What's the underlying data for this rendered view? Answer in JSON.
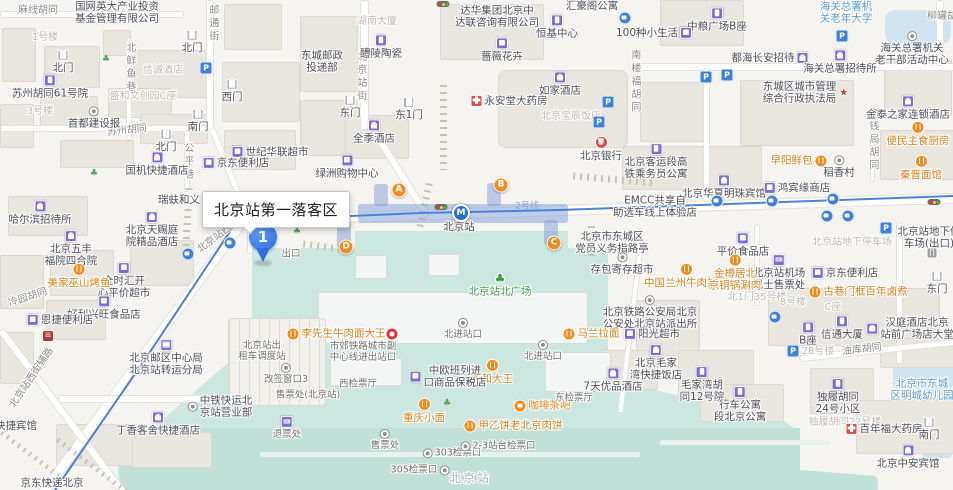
{
  "callout": {
    "text": "北京站第一落客区"
  },
  "marker": {
    "label": "1"
  },
  "metro": {
    "station": "北京站",
    "line": "2号线"
  },
  "colors": {
    "accent_blue": "#2e6ee0",
    "teal": "#cbe7e0",
    "orange": "#f08c1e",
    "poi_purple": "#7d6cd2",
    "metro_line": "#4a82d8",
    "entrance_orange": "#f08c1e"
  },
  "entrances": [
    {
      "label": "A",
      "x": 399,
      "y": 190
    },
    {
      "label": "B",
      "x": 501,
      "y": 185
    },
    {
      "label": "C",
      "x": 554,
      "y": 243
    },
    {
      "label": "D",
      "x": 346,
      "y": 247
    }
  ],
  "labels": [
    {
      "t": "麻线胡同",
      "x": 38,
      "y": 11,
      "k": "road"
    },
    {
      "t": "邮通街",
      "x": 212,
      "y": 24,
      "k": "roadv"
    },
    {
      "t": "北鲜鱼巷",
      "x": 129,
      "y": 68,
      "k": "roadv"
    },
    {
      "t": "苏州胡同",
      "x": 127,
      "y": 131,
      "k": "road",
      "r": -6
    },
    {
      "t": "北京站街",
      "x": 360,
      "y": 77,
      "k": "roadv"
    },
    {
      "t": "公平巷",
      "x": 187,
      "y": 162,
      "k": "roadv"
    },
    {
      "t": "南楼福胡同",
      "x": 634,
      "y": 82,
      "k": "roadv"
    },
    {
      "t": "老钱局胡同",
      "x": 872,
      "y": 140,
      "k": "roadv"
    },
    {
      "t": "柳罐胡同",
      "x": 947,
      "y": 17,
      "k": "road"
    },
    {
      "t": "北京站西街",
      "x": 219,
      "y": 236,
      "k": "road",
      "r": -37
    },
    {
      "t": "北京站西街辅路",
      "x": 32,
      "y": 378,
      "k": "road",
      "r": -56
    },
    {
      "t": "冷园胡同",
      "x": 28,
      "y": 298,
      "k": "road",
      "r": -18
    },
    {
      "t": "油库胡同",
      "x": 862,
      "y": 350,
      "k": "road",
      "r": -7
    },
    {
      "t": "2号线",
      "x": 527,
      "y": 207,
      "k": "line"
    },
    {
      "t": "1号楼",
      "x": 45,
      "y": 38,
      "k": "faint"
    },
    {
      "t": "3号楼",
      "x": 40,
      "y": 112,
      "k": "faint"
    },
    {
      "t": "信诚酒店",
      "x": 163,
      "y": 71,
      "k": "faint"
    },
    {
      "t": "盛和文创园C座",
      "x": 143,
      "y": 97,
      "k": "faint"
    },
    {
      "t": "湖南大厦",
      "x": 377,
      "y": 22,
      "k": "faint"
    },
    {
      "t": "北京宝辰饭店",
      "x": 571,
      "y": 117,
      "k": "faint"
    },
    {
      "t": "北京站地下停车场",
      "x": 852,
      "y": 243,
      "k": "faint"
    },
    {
      "t": "北1门35号楼",
      "x": 757,
      "y": 298,
      "k": "faint"
    },
    {
      "t": "8号楼",
      "x": 793,
      "y": 303,
      "k": "faint"
    },
    {
      "t": "C座",
      "x": 833,
      "y": 308,
      "k": "faint"
    },
    {
      "t": "28号楼",
      "x": 818,
      "y": 352,
      "k": "faint"
    },
    {
      "t": "独履胡同22号楼",
      "x": 845,
      "y": 423,
      "k": "faint"
    },
    {
      "t": "北京站",
      "x": 470,
      "y": 478,
      "k": "bigfaint"
    },
    {
      "t": "国网英大产业投资|基金管理有限公司",
      "x": 117,
      "y": 13,
      "k": "poi"
    },
    {
      "t": "苏州胡同61号院",
      "x": 50,
      "y": 87,
      "k": "poi",
      "i": "bldg",
      "ip": "t"
    },
    {
      "t": "首都建设报",
      "x": 94,
      "y": 118,
      "k": "poi",
      "i": "circ",
      "ip": "t"
    },
    {
      "t": "国机快捷酒店",
      "x": 157,
      "y": 164,
      "k": "poi",
      "i": "hotel",
      "ip": "t"
    },
    {
      "t": "世纪华联超市",
      "x": 270,
      "y": 152,
      "k": "poi",
      "i": "shop",
      "ip": "l"
    },
    {
      "t": "京东便利店",
      "x": 236,
      "y": 163,
      "k": "poi",
      "i": "shop",
      "ip": "l"
    },
    {
      "t": "东城邮政|投递部",
      "x": 322,
      "y": 62,
      "k": "poi"
    },
    {
      "t": "醴陵陶瓷",
      "x": 381,
      "y": 47,
      "k": "poi",
      "i": "bldg",
      "ip": "t"
    },
    {
      "t": "全季酒店",
      "x": 374,
      "y": 132,
      "k": "poi",
      "i": "hotel",
      "ip": "t"
    },
    {
      "t": "绿洲购物中心",
      "x": 347,
      "y": 167,
      "k": "poi",
      "i": "shop",
      "ip": "t"
    },
    {
      "t": "北门",
      "x": 63,
      "y": 62,
      "k": "poi",
      "i": "gate",
      "ip": "t"
    },
    {
      "t": "北门",
      "x": 192,
      "y": 42,
      "k": "poi",
      "i": "gate",
      "ip": "t"
    },
    {
      "t": "南门",
      "x": 198,
      "y": 121,
      "k": "poi",
      "i": "gate",
      "ip": "t"
    },
    {
      "t": "西门",
      "x": 232,
      "y": 91,
      "k": "poi",
      "i": "gate",
      "ip": "t"
    },
    {
      "t": "北门",
      "x": 166,
      "y": 141,
      "k": "poi",
      "i": "gate",
      "ip": "t"
    },
    {
      "t": "东门",
      "x": 350,
      "y": 107,
      "k": "poi",
      "i": "gate",
      "ip": "t"
    },
    {
      "t": "东1门",
      "x": 409,
      "y": 109,
      "k": "poi",
      "i": "gate",
      "ip": "t"
    },
    {
      "t": "达华集团北京中|达联咨询有限公司",
      "x": 497,
      "y": 17,
      "k": "poi"
    },
    {
      "t": "蔷薇花卉",
      "x": 502,
      "y": 50,
      "k": "poi",
      "i": "shop",
      "ip": "t"
    },
    {
      "t": "恒基中心",
      "x": 557,
      "y": 27,
      "k": "poi",
      "i": "bldg",
      "ip": "t"
    },
    {
      "t": "汇豪阁公寓",
      "x": 592,
      "y": 6,
      "k": "poi"
    },
    {
      "t": "如家酒店",
      "x": 560,
      "y": 84,
      "k": "poi",
      "i": "hotel",
      "ip": "t"
    },
    {
      "t": "永安堂大药房",
      "x": 509,
      "y": 101,
      "k": "poi",
      "i": "pharm",
      "ip": "l"
    },
    {
      "t": "北京银行",
      "x": 601,
      "y": 149,
      "k": "poi",
      "i": "bank",
      "ip": "t"
    },
    {
      "t": "中粮广场B座",
      "x": 717,
      "y": 20,
      "k": "poi",
      "i": "bldg",
      "ip": "t"
    },
    {
      "t": "100种小生活",
      "x": 654,
      "y": 33,
      "k": "poi",
      "i": "shop",
      "ip": "r"
    },
    {
      "t": "海关总署机|关老年大学",
      "x": 846,
      "y": 13,
      "k": "blue"
    },
    {
      "t": "海关总署机关|老干部活动中心",
      "x": 912,
      "y": 49,
      "k": "poi",
      "i": "circ",
      "ip": "t"
    },
    {
      "t": "都海长安招待",
      "x": 770,
      "y": 58,
      "k": "poi",
      "i": "hotel",
      "ip": "r"
    },
    {
      "t": "海关总署招待所",
      "x": 840,
      "y": 62,
      "k": "poi",
      "i": "hotel",
      "ip": "t"
    },
    {
      "t": "东城区城市管理|综合行政执法局",
      "x": 806,
      "y": 93,
      "k": "poi",
      "i": "star",
      "ip": "r"
    },
    {
      "t": "金泰之家连锁酒店",
      "x": 908,
      "y": 108,
      "k": "poi",
      "i": "hotel",
      "ip": "t"
    },
    {
      "t": "北京客运段高|铁乘务员公寓",
      "x": 656,
      "y": 162,
      "k": "poi",
      "i": "bldg",
      "ip": "t"
    },
    {
      "t": "北京华夏明珠宾馆",
      "x": 724,
      "y": 187,
      "k": "poi",
      "i": "hotel",
      "ip": "t"
    },
    {
      "t": "鸿宾缘商店",
      "x": 797,
      "y": 188,
      "k": "poi",
      "i": "shop",
      "ip": "l"
    },
    {
      "t": "EMCC共享自|助选车线上体验店",
      "x": 655,
      "y": 207,
      "k": "poi"
    },
    {
      "t": "北京市东城区|党员义务指路亭",
      "x": 612,
      "y": 243,
      "k": "poi"
    },
    {
      "t": "存包寄存超市",
      "x": 622,
      "y": 264,
      "k": "poi",
      "i": "circ",
      "ip": "t"
    },
    {
      "t": "平价食品店",
      "x": 743,
      "y": 245,
      "k": "poi",
      "i": "shop",
      "ip": "t"
    },
    {
      "t": "北京站机场|巴士售票处",
      "x": 779,
      "y": 273,
      "k": "poi",
      "i": "ticket",
      "ip": "t"
    },
    {
      "t": "京东便利店",
      "x": 845,
      "y": 273,
      "k": "poi",
      "i": "shop",
      "ip": "l"
    },
    {
      "t": "北京站地下停|车场(出口)",
      "x": 929,
      "y": 238,
      "k": "poi"
    },
    {
      "t": "东门",
      "x": 937,
      "y": 283,
      "k": "poi",
      "i": "gate",
      "ip": "t"
    },
    {
      "t": "信通大厦",
      "x": 842,
      "y": 328,
      "k": "poi",
      "i": "bldg",
      "ip": "t"
    },
    {
      "t": "B座",
      "x": 808,
      "y": 334,
      "k": "poi",
      "i": "bldg",
      "ip": "t"
    },
    {
      "t": "汉庭酒店北京|站前广场店大堂",
      "x": 910,
      "y": 329,
      "k": "poi",
      "i": "hotel",
      "ip": "l"
    },
    {
      "t": "北京铁路公安局北京|公安处北京站派出所",
      "x": 650,
      "y": 313,
      "k": "poi",
      "i": "circ",
      "ip": "t"
    },
    {
      "t": "阳光超市",
      "x": 652,
      "y": 334,
      "k": "poi",
      "i": "shop",
      "ip": "l"
    },
    {
      "t": "北京毛家|湾快捷饭店",
      "x": 656,
      "y": 363,
      "k": "poi",
      "i": "hotel",
      "ip": "t"
    },
    {
      "t": "7天优品酒店",
      "x": 613,
      "y": 380,
      "k": "poi",
      "i": "hotel",
      "ip": "t"
    },
    {
      "t": "毛家湾胡|同12号院",
      "x": 702,
      "y": 385,
      "k": "poi",
      "i": "bldg",
      "ip": "t"
    },
    {
      "t": "行车公寓|段北京公寓",
      "x": 740,
      "y": 405,
      "k": "poi",
      "i": "bldg",
      "ip": "t"
    },
    {
      "t": "独履胡同|24号小区",
      "x": 838,
      "y": 397,
      "k": "poi",
      "i": "bldg",
      "ip": "t"
    },
    {
      "t": "百年福大药房",
      "x": 884,
      "y": 429,
      "k": "poi",
      "i": "pharm",
      "ip": "l"
    },
    {
      "t": "南门",
      "x": 929,
      "y": 429,
      "k": "poi",
      "i": "gate",
      "ip": "t"
    },
    {
      "t": "北京中安宾馆",
      "x": 908,
      "y": 457,
      "k": "poi",
      "i": "hotel",
      "ip": "t"
    },
    {
      "t": "北京市东城|区明城幼儿园",
      "x": 922,
      "y": 390,
      "k": "blue"
    },
    {
      "t": "哈尔滨招待所",
      "x": 40,
      "y": 213,
      "k": "poi",
      "i": "hotel",
      "ip": "t"
    },
    {
      "t": "北京五丰|福院四合院",
      "x": 71,
      "y": 249,
      "k": "poi",
      "i": "hotel",
      "ip": "t"
    },
    {
      "t": "全时汇开|心平价超市",
      "x": 124,
      "y": 281,
      "k": "poi",
      "i": "shop",
      "ip": "t"
    },
    {
      "t": "好利兴旺食品店",
      "x": 104,
      "y": 308,
      "k": "poi",
      "i": "shop",
      "ip": "t"
    },
    {
      "t": "恩捷便利店",
      "x": 60,
      "y": 320,
      "k": "poi",
      "i": "shop",
      "ip": "l"
    },
    {
      "t": "北京天赐庭|院精品酒店",
      "x": 152,
      "y": 230,
      "k": "poi",
      "i": "hotel",
      "ip": "t"
    },
    {
      "t": "瑞蚨和义",
      "x": 179,
      "y": 200,
      "k": "poi"
    },
    {
      "t": "北京邮区中心局|北京站转运分局",
      "x": 166,
      "y": 358,
      "k": "poi",
      "i": "mail",
      "ip": "t"
    },
    {
      "t": "丁香客舍快捷酒店",
      "x": 158,
      "y": 424,
      "k": "poi",
      "i": "hotel",
      "ip": "t"
    },
    {
      "t": "中铁快运北|京站营业部",
      "x": 220,
      "y": 407,
      "k": "poi",
      "i": "circ",
      "ip": "l"
    },
    {
      "t": "京东快递北京",
      "x": 52,
      "y": 483,
      "k": "poi"
    },
    {
      "t": "快捷宾馆",
      "x": 16,
      "y": 426,
      "k": "poi"
    },
    {
      "t": "便民主食厨房",
      "x": 918,
      "y": 134,
      "k": "food",
      "i": "ut",
      "ip": "t"
    },
    {
      "t": "早阳鲜包",
      "x": 799,
      "y": 161,
      "k": "food",
      "i": "ut",
      "ip": "r"
    },
    {
      "t": "稻香村",
      "x": 839,
      "y": 167,
      "k": "poi",
      "i": "circ",
      "ip": "t"
    },
    {
      "t": "秦晋面馆",
      "x": 921,
      "y": 168,
      "k": "food",
      "i": "ut",
      "ip": "t"
    },
    {
      "t": "中国兰州牛肉拉面",
      "x": 686,
      "y": 276,
      "k": "food",
      "i": "ut",
      "ip": "t"
    },
    {
      "t": "金樽居北|京铜锅涮肉",
      "x": 735,
      "y": 273,
      "k": "food",
      "i": "ut",
      "ip": "t"
    },
    {
      "t": "古巷门框百年卤煮",
      "x": 858,
      "y": 292,
      "k": "food",
      "i": "ut",
      "ip": "l"
    },
    {
      "t": "马兰拉面",
      "x": 591,
      "y": 334,
      "k": "food",
      "i": "ut",
      "ip": "l"
    },
    {
      "t": "李先生牛肉面大王",
      "x": 336,
      "y": 334,
      "k": "food",
      "i": "ut",
      "ip": "l"
    },
    {
      "t": "永和大王",
      "x": 492,
      "y": 372,
      "k": "food",
      "i": "ut",
      "ip": "t"
    },
    {
      "t": "咖啡茶吧",
      "x": 542,
      "y": 406,
      "k": "food",
      "i": "coffee",
      "ip": "l"
    },
    {
      "t": "重庆小面",
      "x": 424,
      "y": 411,
      "k": "food",
      "i": "ut",
      "ip": "t"
    },
    {
      "t": "甲乙饼老北京肉饼",
      "x": 513,
      "y": 426,
      "k": "food",
      "i": "ut",
      "ip": "l"
    },
    {
      "t": "美家巫山烤鱼",
      "x": 79,
      "y": 276,
      "k": "food",
      "i": "ut",
      "ip": "t"
    },
    {
      "t": "北京站北广场",
      "x": 500,
      "y": 285,
      "k": "green",
      "i": "tree",
      "ip": "t"
    },
    {
      "t": "出口",
      "x": 291,
      "y": 254,
      "k": "station"
    },
    {
      "t": "北进站口",
      "x": 463,
      "y": 329,
      "k": "station",
      "i": "circ",
      "ip": "t"
    },
    {
      "t": "北进站口",
      "x": 543,
      "y": 351,
      "k": "station",
      "i": "circ",
      "ip": "t"
    },
    {
      "t": "北京站出|租车调度站",
      "x": 262,
      "y": 351,
      "k": "station"
    },
    {
      "t": "市郊铁路城市副|中心线进出站口",
      "x": 363,
      "y": 352,
      "k": "station"
    },
    {
      "t": "改签窗口3",
      "x": 286,
      "y": 374,
      "k": "station",
      "i": "circ",
      "ip": "t"
    },
    {
      "t": "西检票厅",
      "x": 358,
      "y": 384,
      "k": "station"
    },
    {
      "t": "售票处(北京站)",
      "x": 308,
      "y": 395,
      "k": "station"
    },
    {
      "t": "中欧班列进|口商品保税店",
      "x": 448,
      "y": 377,
      "k": "poi",
      "i": "shop",
      "ip": "l"
    },
    {
      "t": "退票处",
      "x": 287,
      "y": 428,
      "k": "station",
      "i": "ticket",
      "ip": "t"
    },
    {
      "t": "售票处",
      "x": 385,
      "y": 440,
      "k": "station",
      "i": "circ",
      "ip": "t"
    },
    {
      "t": "303检票口",
      "x": 452,
      "y": 453,
      "k": "station",
      "i": "circ",
      "ip": "l"
    },
    {
      "t": "2-3站台检票口",
      "x": 498,
      "y": 446,
      "k": "station",
      "i": "circ",
      "ip": "l"
    },
    {
      "t": "305检票口",
      "x": 420,
      "y": 470,
      "k": "station",
      "i": "circ",
      "ip": "r"
    },
    {
      "t": "东检票厅",
      "x": 574,
      "y": 398,
      "k": "station"
    },
    {
      "t": "北京站",
      "x": 459,
      "y": 227,
      "k": "stationbold"
    }
  ],
  "icons": [
    {
      "k": "parking",
      "x": 206,
      "y": 68
    },
    {
      "k": "parking",
      "x": 842,
      "y": 36
    },
    {
      "k": "parking",
      "x": 706,
      "y": 77
    },
    {
      "k": "parking",
      "x": 727,
      "y": 75
    },
    {
      "k": "parking",
      "x": 608,
      "y": 102
    },
    {
      "k": "parking",
      "x": 599,
      "y": 122
    },
    {
      "k": "parking",
      "x": 886,
      "y": 228
    },
    {
      "k": "parking",
      "x": 793,
      "y": 351
    },
    {
      "k": "traffic",
      "x": 443,
      "y": 4
    },
    {
      "k": "traffic",
      "x": 441,
      "y": 207
    },
    {
      "k": "traffic",
      "x": 934,
      "y": 202
    },
    {
      "k": "bus",
      "x": 188,
      "y": 254
    },
    {
      "k": "bus",
      "x": 230,
      "y": 243
    },
    {
      "k": "bus",
      "x": 625,
      "y": 18
    },
    {
      "k": "bus",
      "x": 717,
      "y": 201
    },
    {
      "k": "bus",
      "x": 772,
      "y": 201
    },
    {
      "k": "bus",
      "x": 833,
      "y": 199
    },
    {
      "k": "bus",
      "x": 827,
      "y": 216
    },
    {
      "k": "bus",
      "x": 848,
      "y": 216
    },
    {
      "k": "bus",
      "x": 775,
      "y": 317
    },
    {
      "k": "metro",
      "x": 461,
      "y": 213
    },
    {
      "k": "treesm",
      "x": 297,
      "y": 232
    },
    {
      "k": "treesm",
      "x": 106,
      "y": 60
    },
    {
      "k": "treesm",
      "x": 94,
      "y": 174
    },
    {
      "k": "treesm",
      "x": 447,
      "y": 404
    },
    {
      "k": "taxi",
      "x": 48,
      "y": 336
    },
    {
      "k": "redcirc",
      "x": 392,
      "y": 334
    },
    {
      "k": "gate",
      "x": 932,
      "y": 253
    }
  ]
}
